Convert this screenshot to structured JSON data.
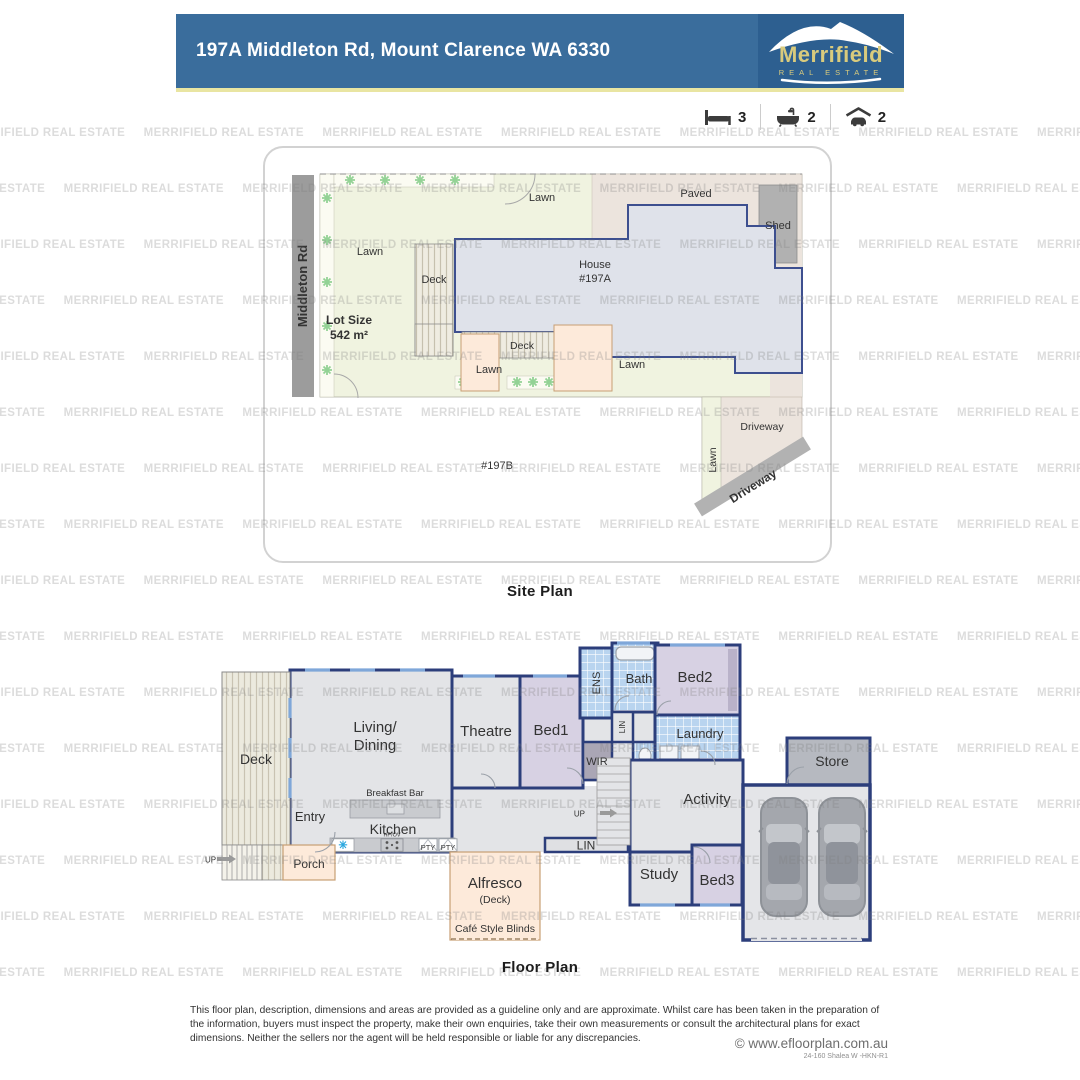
{
  "header": {
    "address": "197A Middleton Rd, Mount Clarence WA 6330",
    "logo": {
      "name": "Merrifield",
      "tagline": "REAL ESTATE"
    }
  },
  "summary": {
    "items": [
      {
        "icon": "bed-icon",
        "count": "3"
      },
      {
        "icon": "bath-icon",
        "count": "2"
      },
      {
        "icon": "car-garage-icon",
        "count": "2"
      }
    ]
  },
  "watermark": {
    "text": "MERRIFIELD REAL ESTATE"
  },
  "site_plan": {
    "title": "Site Plan",
    "road": "Middleton Rd",
    "lot_size_line1": "Lot Size",
    "lot_size_line2": "542 m²",
    "house_line1": "House",
    "house_line2": "#197A",
    "labels": {
      "lawn": "Lawn",
      "deck": "Deck",
      "paved": "Paved",
      "shed": "Shed",
      "driveway": "Driveway",
      "neighbour": "#197B"
    }
  },
  "floor_plan": {
    "title": "Floor Plan",
    "rooms": {
      "deck": "Deck",
      "living1": "Living/",
      "living2": "Dining",
      "theatre": "Theatre",
      "bed1": "Bed1",
      "ens": "ENS",
      "bath": "Bath",
      "lin": "LIN",
      "wir": "WIR",
      "bed2": "Bed2",
      "laundry": "Laundry",
      "store": "Store",
      "activity": "Activity",
      "entry": "Entry",
      "breakfast_bar": "Breakfast Bar",
      "kitchen": "Kitchen",
      "hpov": "HP/OV",
      "pty": "PTY",
      "porch": "Porch",
      "alfresco": "Alfresco",
      "alfresco_sub": "(Deck)",
      "blinds": "Café Style Blinds",
      "lin2": "LIN",
      "study": "Study",
      "bed3": "Bed3",
      "up": "UP"
    }
  },
  "footer": {
    "disclaimer": "This floor plan, description, dimensions and areas are provided as a guideline only and are approximate. Whilst care has been taken in the preparation of the information, buyers must inspect the property, make their own enquiries, take their own measurements or consult the architectural plans for exact dimensions. Neither the sellers nor the agent will be held responsible or liable for any discrepancies.",
    "credit": "© www.efloorplan.com.au",
    "ref": "24-160 Shalea W -HKN-R1"
  },
  "colors": {
    "header_blue": "#3a6d9c",
    "logo_blue": "#2d5f90",
    "logo_gold": "#d9cb7d",
    "yellow_strip": "#e9e5a2",
    "wall_navy": "#2c3e7b",
    "lawn": "#f0f3e0",
    "paved": "#ece4dd",
    "bedroom_purple": "#d7d1e3",
    "tile_blue": "#b9d4ef",
    "peach": "#fdeada"
  }
}
